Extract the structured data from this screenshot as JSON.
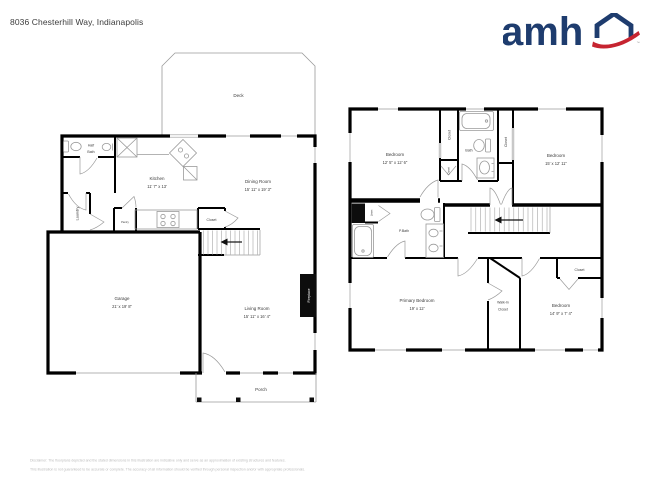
{
  "header": {
    "title": "8036 Chesterhill Way, Indianapolis"
  },
  "logo": {
    "text": "amh",
    "trademark": "™"
  },
  "colors": {
    "brand_navy": "#1e3c6e",
    "brand_red": "#c62430",
    "wall": "#000000",
    "fixture_line": "#9a9a9a",
    "label_text": "#3c3c3c",
    "disclaimer_text": "#bcbcbc"
  },
  "floor1": {
    "deck": {
      "label": "Deck"
    },
    "half_bath": {
      "line1": "Half",
      "line2": "Bath"
    },
    "kitchen": {
      "name": "Kitchen",
      "dims": "11' 7\" x 13'"
    },
    "dining_room": {
      "name": "Dining Room",
      "dims": "15' 11\" x 19' 3\""
    },
    "laundry": {
      "label": "Laundry"
    },
    "pantry": {
      "label": "Pantry"
    },
    "closet": {
      "label": "Closet"
    },
    "garage": {
      "name": "Garage",
      "dims": "21' x 19' 8\""
    },
    "living_room": {
      "name": "Living Room",
      "dims": "15' 11\" x 16' 4\""
    },
    "fireplace": {
      "label": "Fireplace"
    },
    "porch": {
      "label": "Porch"
    }
  },
  "floor2": {
    "bedroom_top_left": {
      "name": "Bedroom",
      "dims": "12' 5\" x 12' 6\""
    },
    "closet_hall": {
      "label": "Closet"
    },
    "closet_small": {
      "label": "Closet"
    },
    "bath": {
      "label": "Bath"
    },
    "closet_bedroom2": {
      "label": "Closet"
    },
    "bedroom_top_right": {
      "name": "Bedroom",
      "dims": "15' x 12' 11\""
    },
    "linen": {
      "label": "Linen"
    },
    "primary_bath": {
      "label": "P.Bath"
    },
    "primary_bedroom": {
      "name": "Primary Bedroom",
      "dims": "19' x 12'"
    },
    "walk_in_closet": {
      "line1": "Walk-In",
      "line2": "Closet"
    },
    "bedroom_bottom_right": {
      "name": "Bedroom",
      "dims": "14' 9\" x 7' 4\""
    },
    "closet_bedroom3": {
      "label": "Closet"
    }
  },
  "footer": {
    "line1": "Disclaimer: The floorplans depicted and the stated dimensions in this illustration are indicative only and serve as an approximation of existing structures and features.",
    "line2": "This illustration is not guaranteed to be accurate or complete. The accuracy of all information should be verified through personal inspection and/or with appropriate professionals."
  }
}
